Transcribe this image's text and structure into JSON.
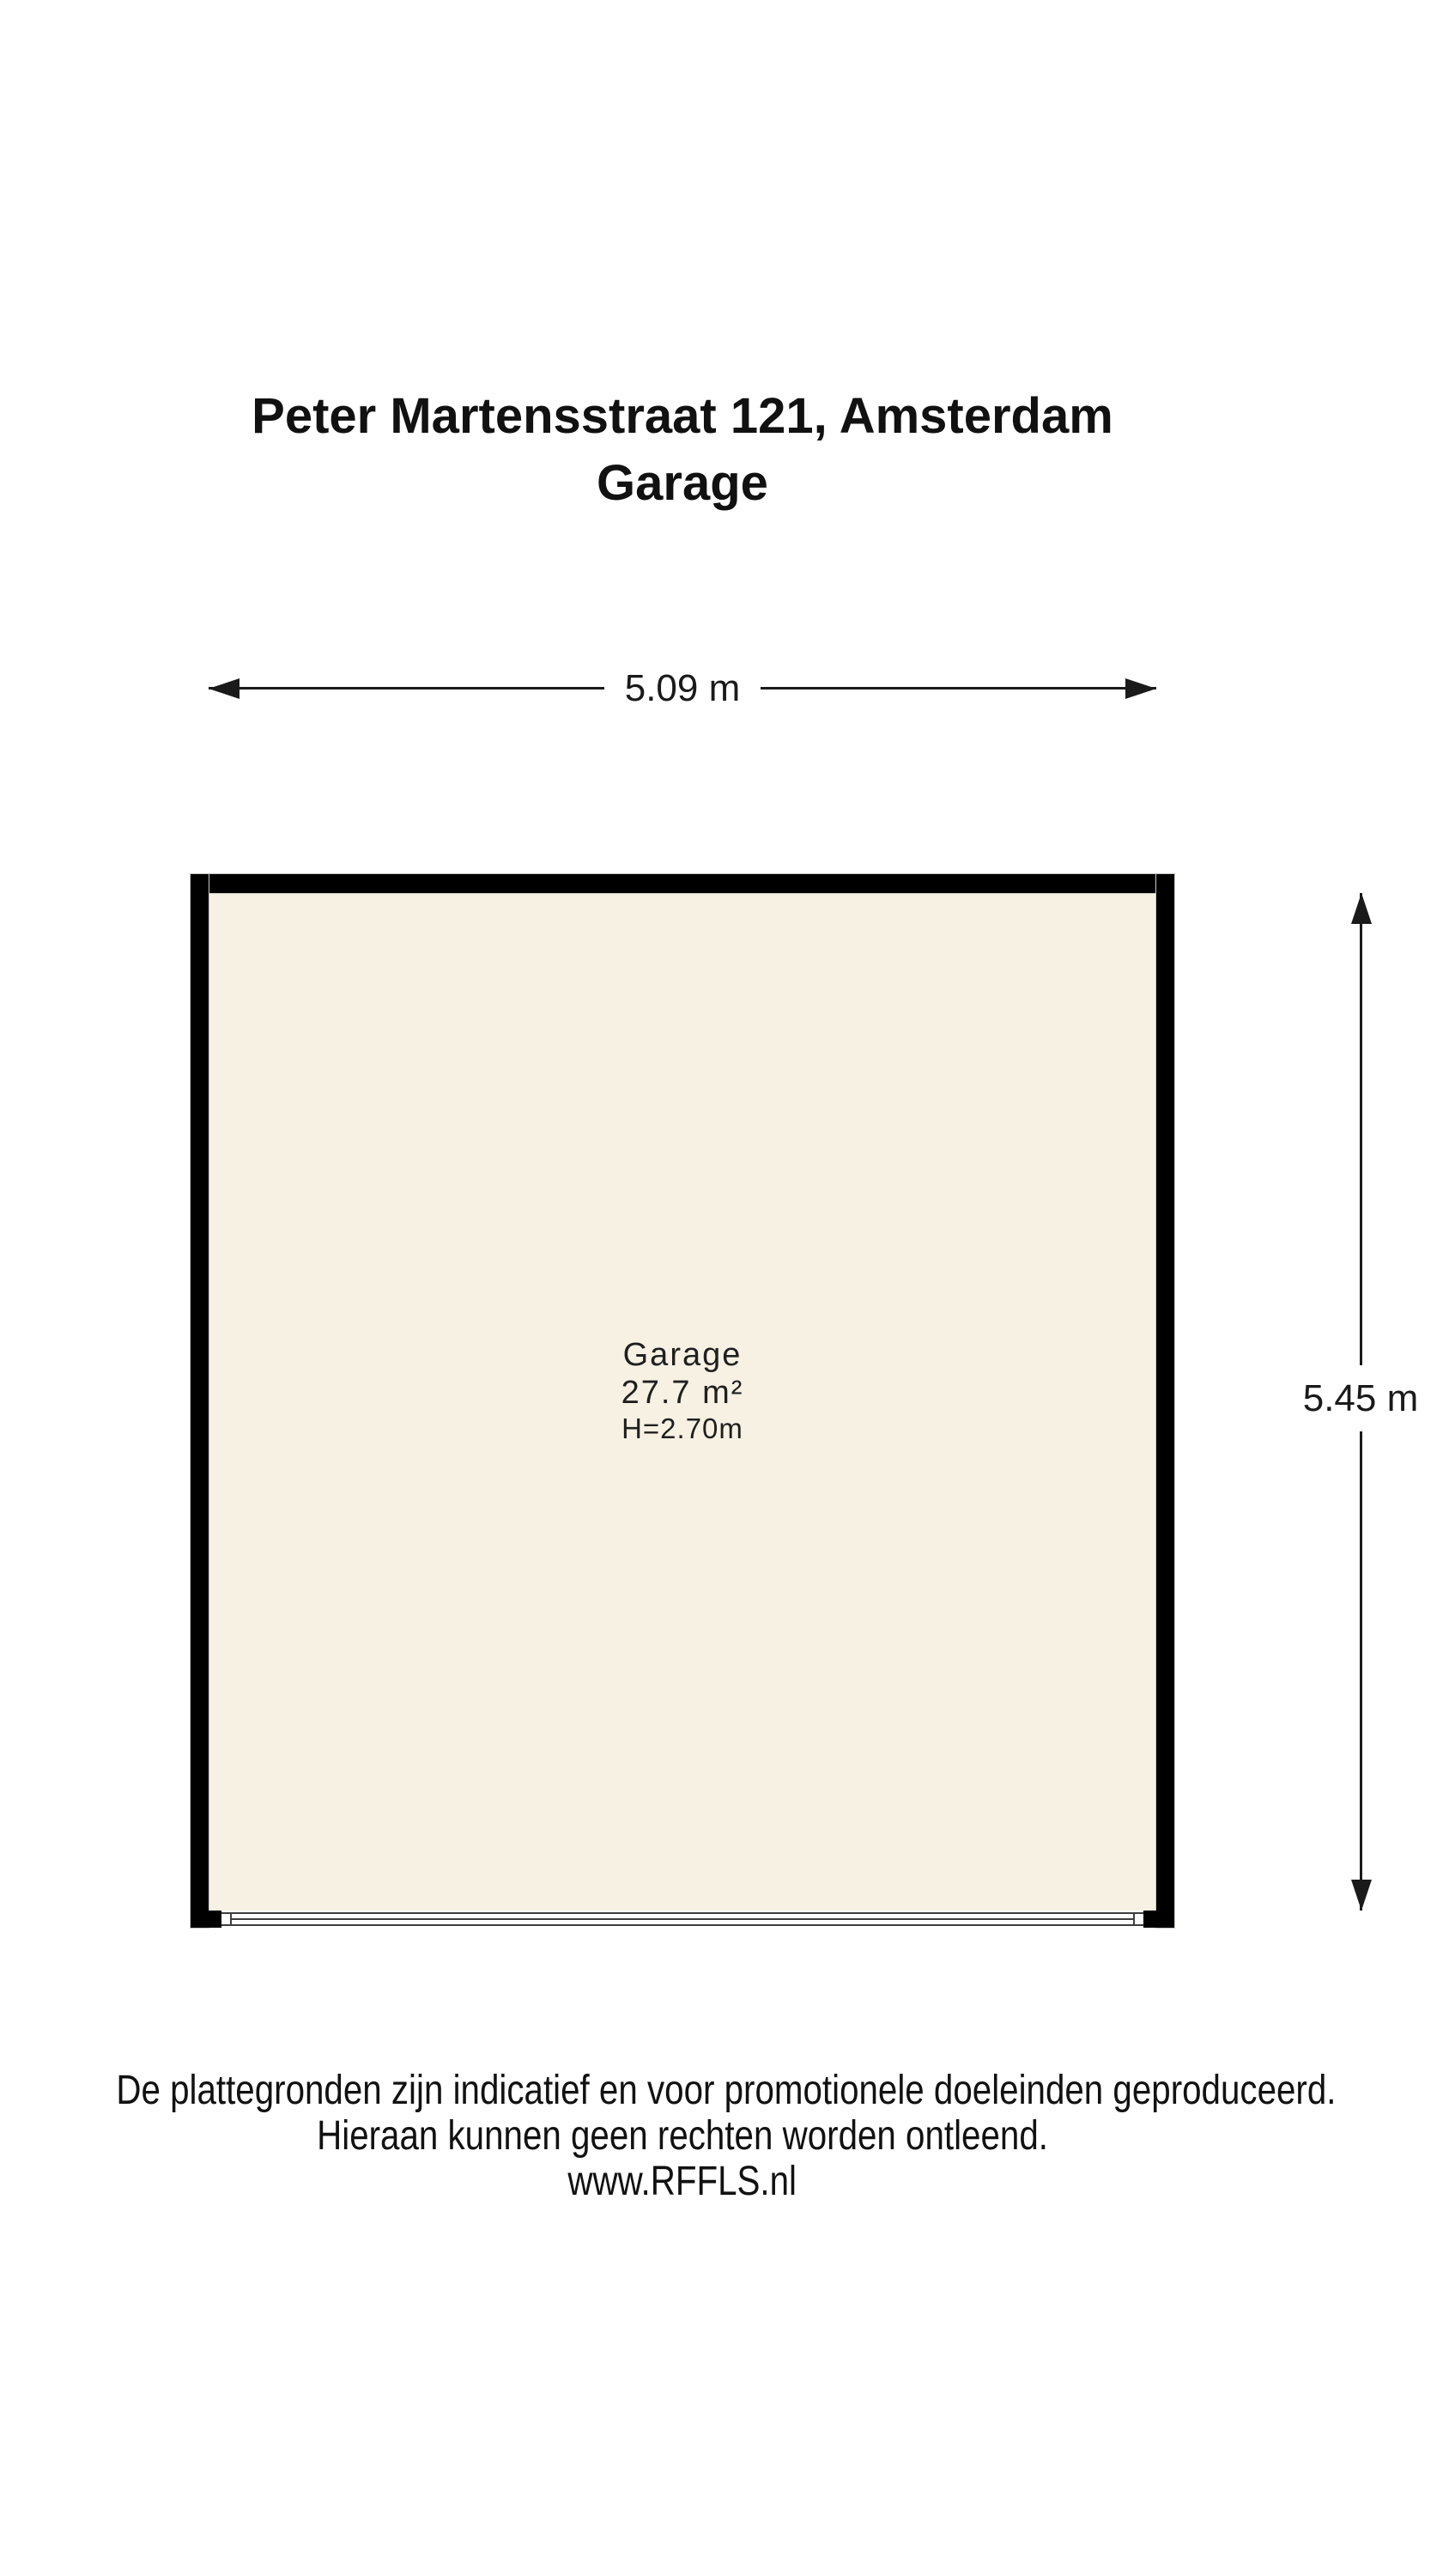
{
  "title": {
    "line1": "Peter Martensstraat 121, Amsterdam",
    "line2": "Garage"
  },
  "dimensions": {
    "width_label": "5.09 m",
    "height_label": "5.45 m"
  },
  "room": {
    "name": "Garage",
    "area": "27.7 m²",
    "ceiling_height": "H=2.70m"
  },
  "disclaimer": {
    "line1": "De plattegronden zijn indicatief en voor promotionele doeleinden geproduceerd.",
    "line2": "Hieraan kunnen geen rechten worden ontleend.",
    "line3": "www.RFFLS.nl"
  },
  "colors": {
    "wall": "#000000",
    "floor_fill": "#f6f1e3",
    "text": "#1a1a1a",
    "dimension_line": "#1a1a1a",
    "door_line": "#3d3d3d",
    "background": "#ffffff"
  }
}
